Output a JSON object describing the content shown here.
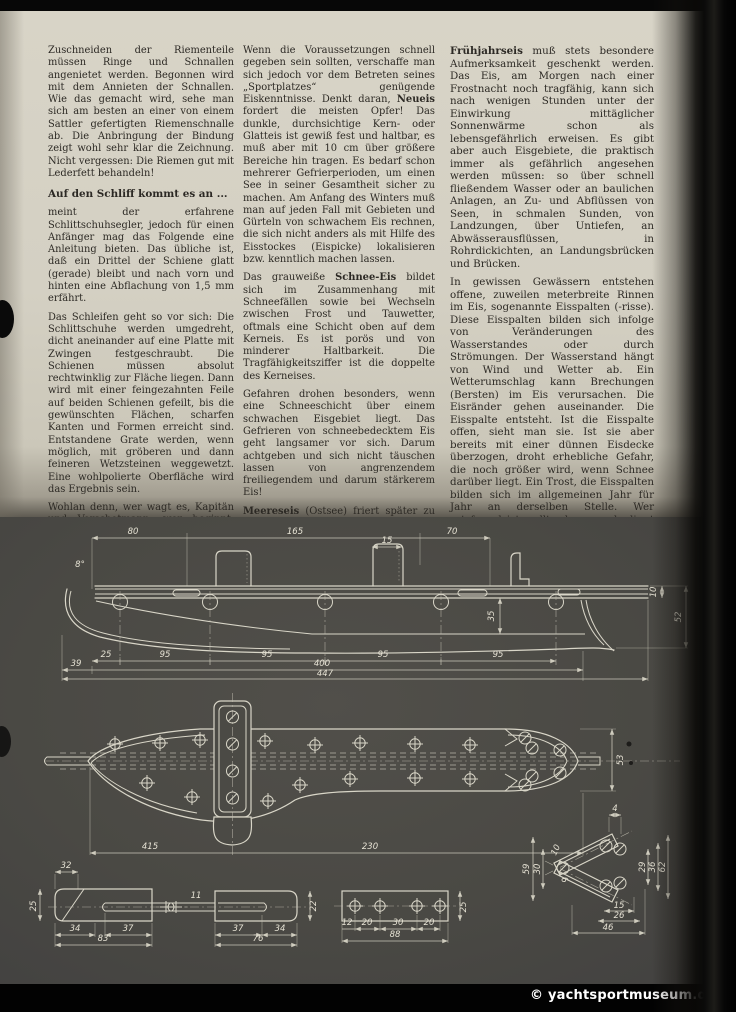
{
  "page": {
    "watermark": "© yachtsportmuseum.de"
  },
  "article": {
    "col1": {
      "p1": "Zuschneiden der Riementeile müssen Ringe und Schnallen angenietet werden. Begonnen wird mit dem Annieten der Schnallen. Wie das gemacht wird, sehe man sich am besten an einer von einem Sattler gefertigten Riemenschnalle ab. Die Anbringung der Bindung zeigt wohl sehr klar die Zeichnung. Nicht vergessen: Die Riemen gut mit Lederfett behandeln!",
      "heading": "Auf den Schliff kommt es an ...",
      "p2": "meint der erfahrene Schlittschuhsegler, jedoch für einen Anfänger mag das Folgende eine Anleitung bieten. Das übliche ist, daß ein Drittel der Schiene glatt (gerade) bleibt und nach vorn und hinten eine Abflachung von 1,5 mm erfährt.",
      "p3": "Das Schleifen geht so vor sich: Die Schlittschuhe werden umgedreht, dicht aneinander auf eine Platte mit Zwingen festgeschraubt. Die Schienen müssen absolut rechtwinklig zur Fläche liegen. Dann wird mit einer feingezahnten Feile auf beiden Schienen gefeilt, bis die gewünschten Flächen, scharfen Kanten und Formen erreicht sind. Entstandene Grate werden, wenn möglich, mit gröberen und dann feineren Wetzsteinen weggewetzt. Eine wohlpolierte Oberfläche wird das Ergebnis sein.",
      "p4": "Wohlan denn, wer wagt es, Kapitän und Vorschotmann, wer beginnt, macht den Anfang und berichtet über seine Erfahrungen im Selbstbau und im Schlittschuhsegellauf?"
    },
    "col2": {
      "p1a": "Wenn die Voraussetzungen schnell gegeben sein sollten, verschaffe man sich jedoch vor dem Betreten seines „Sportplatzes“ genügende Eiskenntnisse. Denkt daran, ",
      "p1b": "Neueis",
      "p1c": " fordert die meisten Opfer! Das dunkle, durchsichtige Kern- oder Glatteis ist gewiß fest und haltbar, es muß aber mit 10 cm über größere Bereiche hin tragen. Es bedarf schon mehrerer Gefrierperioden, um einen See in seiner Gesamtheit sicher zu machen. Am Anfang des Winters muß man auf jeden Fall mit Gebieten und Gürteln von schwachem Eis rechnen, die sich nicht anders als mit Hilfe des Eisstockes (Eispicke) lokalisieren bzw. kenntlich machen lassen.",
      "p2a": "Das grauweiße ",
      "p2b": "Schnee-Eis",
      "p2c": " bildet sich im Zusammenhang mit Schneefällen sowie bei Wechseln zwischen Frost und Tauwetter, oftmals eine Schicht oben auf dem Kerneis. Es ist porös und von minderer Haltbarkeit. Die Tragfähigkeitsziffer ist die doppelte des Kerneises.",
      "p3": "Gefahren drohen besonders, wenn eine Schneeschicht über einem schwachen Eisgebiet liegt. Das Gefrieren von schneebedecktem Eis geht langsamer vor sich. Darum achtgeben und sich nicht täuschen lassen von angrenzendem freiliegendem und darum stärkerem Eis!",
      "p4a": "Meereseis",
      "p4b": " (Ostsee) friert später zu und geht früher auf als das Süßwassereis. Die Entstehung von Treibeis ist leicht gegeben, besonders bei ablandigem Wind."
    },
    "col3": {
      "p1a": "Frühjahrseis",
      "p1b": " muß stets besondere Aufmerksamkeit geschenkt werden. Das Eis, am Morgen nach einer Frostnacht noch tragfähig, kann sich nach wenigen Stunden unter der Einwirkung mittäglicher Sonnenwärme schon als lebensgefährlich erweisen. Es gibt aber auch Eisgebiete, die praktisch immer als gefährlich angesehen werden müssen: so über schnell fließendem Wasser oder an baulichen Anlagen, an Zu- und Abflüssen von Seen, in schmalen Sunden, von Landzungen, über Untiefen, an Abwässerausflüssen, in Rohrdickichten, an Landungsbrücken und Brücken.",
      "p2": "In gewissen Gewässern entstehen offene, zuweilen meterbreite Rinnen im Eis, sogenannte Eisspalten (-risse). Diese Eisspalten bilden sich infolge von Veränderungen des Wasserstandes oder durch Strömungen. Der Wasserstand hängt von Wind und Wetter ab. Ein Wetterumschlag kann Brechungen (Bersten) im Eis verursachen. Die Eisränder gehen auseinander. Die Eisspalte entsteht. Ist die Eisspalte offen, sieht man sie. Ist sie aber bereits mit einer dünnen Eisdecke überzogen, droht erhebliche Gefahr, die noch größer wird, wenn Schnee darüber liegt. Ein Trost, die Eisspalten bilden sich im allgemeinen Jahr für Jahr an derselben Stelle. Wer ortsfremd ist, sollte darum unbedingt auf den Rat Ortsansässiger hören."
    }
  },
  "drawing": {
    "side_view": {
      "top": [
        "80",
        "165",
        "70"
      ],
      "post_width": "15",
      "angle": "8°",
      "segments": [
        "25",
        "95",
        "95",
        "95",
        "95"
      ],
      "left_overhang": "39",
      "length": "400",
      "total_length": "447",
      "blade_height": "35",
      "tail_small": "10",
      "tail_height": "52"
    },
    "plan_view": {
      "front_length": "415",
      "rear_length": "230",
      "head_width": "53"
    },
    "detail_a": {
      "top_width": "32",
      "height": "25",
      "d1": "34",
      "d2": "37",
      "total": "83"
    },
    "detail_b": {
      "pin": "11",
      "d1": "37",
      "d2": "34",
      "total": "76",
      "height": "22"
    },
    "detail_c": {
      "d1": "12",
      "d2": "20",
      "d3": "30",
      "d4": "20",
      "total": "88",
      "height": "25"
    },
    "detail_d": {
      "top": "4",
      "l1": "59",
      "l2": "30",
      "l3": "10",
      "l4": "6",
      "r1": "29",
      "r2": "36",
      "r3": "62",
      "b1": "15",
      "b2": "26",
      "b3": "46"
    }
  }
}
